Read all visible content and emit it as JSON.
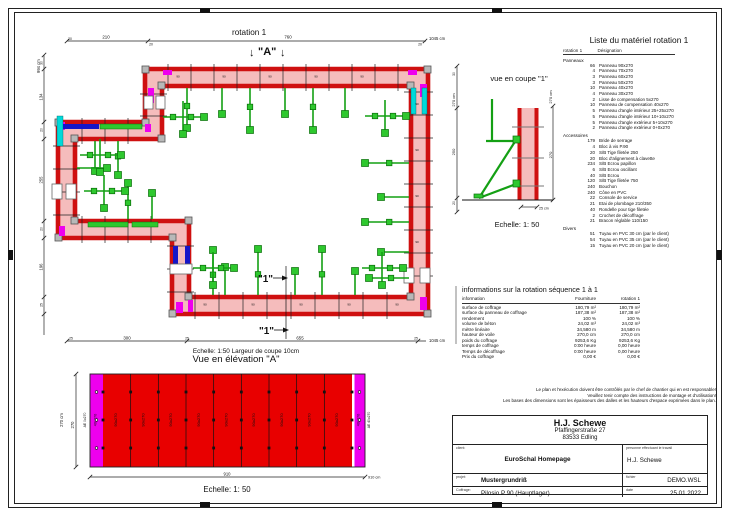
{
  "plan": {
    "title": "rotation 1",
    "section_a": "\"A\"",
    "section_1": "\"1\"",
    "panel_width_label": "90",
    "dim_top": {
      "segments": [
        "20",
        "210",
        "20",
        "760",
        "20"
      ],
      "total": "1045 cm"
    },
    "dim_left": {
      "segments": [
        "30",
        "134",
        "20",
        "255",
        "20",
        "196",
        "25"
      ],
      "total": "994 cm"
    },
    "dim_bottom": {
      "segments": [
        "25",
        "300",
        "25",
        "655",
        "25"
      ],
      "total": "1045 cm"
    },
    "scale_note": "Echelle: 1:50   Largeur de coupe 10cm"
  },
  "coupe": {
    "title": "vue en coupe \"1\"",
    "dim_left_segments": [
      "30",
      "250",
      "20"
    ],
    "dim_left_total": "270 cm",
    "dim_right_total": "270 cm",
    "dim_right_segment": "270",
    "dim_width": "25 cm",
    "scale": "Echelle: 1: 50"
  },
  "elevation": {
    "title": "Vue en élévation \"A\"",
    "scale": "Echelle: 1: 50",
    "panel_label": "90x270",
    "comp_label": "40x270",
    "edge_left_label": "AE 0x270",
    "edge_right_label": "AE 40x270",
    "dim_left_total": "270 cm",
    "dim_left_segment": "270",
    "dim_bottom_segment": "910",
    "dim_bottom_total": "910 cm"
  },
  "material_list": {
    "title": "Liste du matériel  rotation 1",
    "col_qty": "rotation 1",
    "col_name": "Désignation",
    "sections": [
      {
        "name": "Panneaux",
        "items": [
          [
            66,
            "Panneau 90x270"
          ],
          [
            4,
            "Panneau 70x270"
          ],
          [
            3,
            "Panneau 60x270"
          ],
          [
            3,
            "Panneau 50x270"
          ],
          [
            10,
            "Panneau 40x270"
          ],
          [
            4,
            "Panneau 30x270"
          ],
          [
            2,
            "Lisse de compensation 5x270"
          ],
          [
            10,
            "Panneau de compensation 40x270"
          ],
          [
            5,
            "Panneau d'angle intérieur 25+25x270"
          ],
          [
            5,
            "Panneau d'angle intérieur 10+10x270"
          ],
          [
            5,
            "Panneau d'angle extérieur 5+10x270"
          ],
          [
            2,
            "Panneau d'angle extérieur 0+0x270"
          ]
        ]
      },
      {
        "name": "Accessoires",
        "items": [
          [
            179,
            "Bride de serrage"
          ],
          [
            4,
            "Bloc à vis P.90"
          ],
          [
            20,
            "S/B Tige filetée 250"
          ],
          [
            20,
            "Bloc d'alignement à clavette"
          ],
          [
            234,
            "S/B Ecrou papillon"
          ],
          [
            6,
            "S/B Ecrou oscillant"
          ],
          [
            40,
            "S/B Ecrou"
          ],
          [
            120,
            "S/B Tige filetée 750"
          ],
          [
            240,
            "Bouchon"
          ],
          [
            240,
            "Cône en PVC"
          ],
          [
            22,
            "Console de service"
          ],
          [
            21,
            "Etai de plombage 210/350"
          ],
          [
            40,
            "Rondelle pour tige filetée"
          ],
          [
            2,
            "Crochet de décoffrage"
          ],
          [
            21,
            "Bracon réglable 110/150"
          ]
        ]
      },
      {
        "name": "Divers",
        "items": [
          [
            51,
            "Tuyau en PVC 30 cm (par le client)"
          ],
          [
            54,
            "Tuyau en PVC 35 cm (par le client)"
          ],
          [
            15,
            "Tuyau en PVC 20 cm (par le client)"
          ]
        ]
      }
    ]
  },
  "info_table": {
    "title": "informations sur la rotation  séquence 1 à 1",
    "headers": [
      "information",
      "Fourniture",
      "rotation 1"
    ],
    "rows": [
      [
        "surface de coffrage",
        "180,79 m²",
        "180,79 m²"
      ],
      [
        "surface du panneau de coffrage",
        "187,38 m²",
        "187,38 m²"
      ],
      [
        "rendement",
        "100 %",
        "100 %"
      ],
      [
        "volume de béton",
        "24,02 m³",
        "24,02 m³"
      ],
      [
        "mètre linéaire",
        "34,580 m",
        "34,580 m"
      ],
      [
        "hauteur de voile",
        "270,0 cm",
        "270,0 cm"
      ],
      [
        "poids du coffrage",
        "9253,6 Kg",
        "9253,6 Kg"
      ],
      [
        "temps de coffrage",
        "0:00 heure",
        "0,00 heure"
      ],
      [
        "Temps de décoffrage",
        "0:00 heure",
        "0,00 heure"
      ],
      [
        "Prix du coffrage",
        "0,00 €",
        "0,00 €"
      ]
    ]
  },
  "footnote": {
    "lines": [
      "Le plan et l'exécution doivent être contrôlés par le chef de chantier qui en est responsable!",
      "Veuillez tenir compte des instructions de montage et d'utilisation!",
      "Les bases des dimensions sont les épaisseurs des dalles et les hauteurs d'espace exprimées dans le plan."
    ]
  },
  "title_block": {
    "company": "H.J. Schewe",
    "address1": "Pfaffingerstraße 27",
    "address2": "83533 Edling",
    "client_label": "client:",
    "client": "EuroSchal Homepage",
    "worker_label": "personne effectuant le travail",
    "worker": "H.J. Schewe",
    "project_label": "projet:",
    "project": "Mustergrundriß",
    "file_label": "fichier",
    "file": "DEMO.WSL",
    "formwork_label": "Coffrage:",
    "formwork": "Pilosio P 90 (Hauptlager)",
    "date_label": "date",
    "date": "25.01.2022"
  },
  "colors": {
    "wall_red": "#cf1010",
    "wall_core_pink": "#f5bcbc",
    "accessory_green": "#14a014",
    "accessory_green_fill": "#2ec82e",
    "comp_magenta": "#ee00ee",
    "corner_cyan": "#00d9d9",
    "block_blue": "#1616c8",
    "panel_number_red": "#8a0000"
  }
}
